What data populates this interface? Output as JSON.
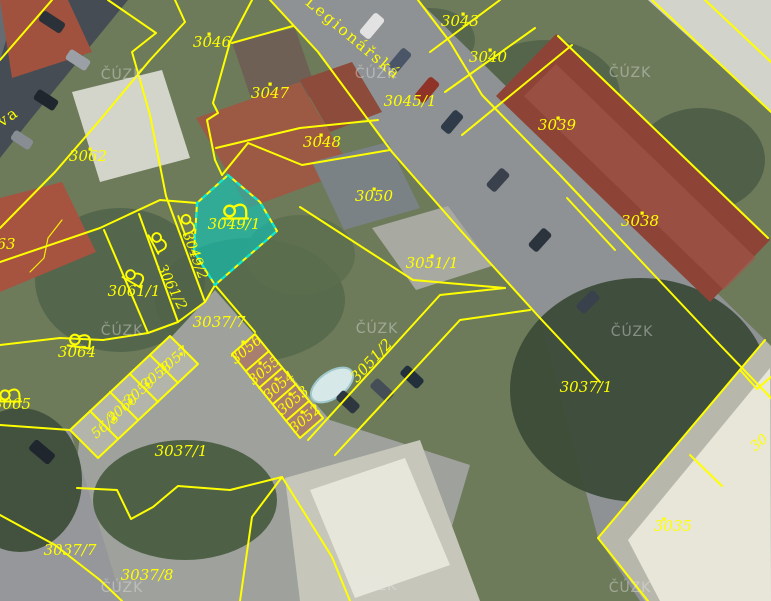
{
  "map": {
    "watermark_text": "ČÚZK",
    "watermarks": [
      {
        "x": 122,
        "y": 79
      },
      {
        "x": 376,
        "y": 78
      },
      {
        "x": 630,
        "y": 77
      },
      {
        "x": 122,
        "y": 335
      },
      {
        "x": 377,
        "y": 333
      },
      {
        "x": 632,
        "y": 336
      },
      {
        "x": 122,
        "y": 592
      },
      {
        "x": 376,
        "y": 590
      },
      {
        "x": 630,
        "y": 592
      }
    ],
    "street_labels": [
      {
        "text": "Legionářská",
        "x": 350,
        "y": 42,
        "rot": 40,
        "size": 15.5
      },
      {
        "text": "va",
        "x": 11,
        "y": 121,
        "rot": -35,
        "size": 15.5
      }
    ],
    "selected_parcel": "3049/1",
    "colors": {
      "boundary": "#ffff00",
      "label": "#ffff00",
      "highlight_fill": "#00d2c8",
      "highlight_stroke": "#00ecdc",
      "watermark": "#e8e8e8"
    },
    "parcel_labels": [
      {
        "text": "3046",
        "x": 212,
        "y": 47,
        "rot": 0,
        "size": 15,
        "dot": [
          209,
          34
        ]
      },
      {
        "text": "3047",
        "x": 270,
        "y": 98,
        "rot": 0,
        "size": 15,
        "dot": [
          270,
          84
        ]
      },
      {
        "text": "3048",
        "x": 322,
        "y": 147,
        "rot": 0,
        "size": 15,
        "dot": [
          321,
          135
        ]
      },
      {
        "text": "3045/1",
        "x": 410,
        "y": 106,
        "rot": 0,
        "size": 15,
        "dot": null
      },
      {
        "text": "3043",
        "x": 460,
        "y": 26,
        "rot": 0,
        "size": 15,
        "dot": [
          463,
          14
        ]
      },
      {
        "text": "3040",
        "x": 488,
        "y": 62,
        "rot": 0,
        "size": 15,
        "dot": [
          490,
          50
        ]
      },
      {
        "text": "3039",
        "x": 557,
        "y": 130,
        "rot": 0,
        "size": 15,
        "dot": [
          558,
          118
        ]
      },
      {
        "text": "3038",
        "x": 640,
        "y": 226,
        "rot": 0,
        "size": 15,
        "dot": [
          642,
          213
        ]
      },
      {
        "text": "3050",
        "x": 374,
        "y": 201,
        "rot": 0,
        "size": 15,
        "dot": [
          374,
          189
        ]
      },
      {
        "text": "3051/1",
        "x": 432,
        "y": 268,
        "rot": 0,
        "size": 15,
        "dot": [
          432,
          256
        ]
      },
      {
        "text": "3049/1",
        "x": 234,
        "y": 229,
        "rot": 0,
        "size": 15,
        "dot": null
      },
      {
        "text": "3049/2",
        "x": 191,
        "y": 257,
        "rot": 70,
        "size": 14,
        "dot": null
      },
      {
        "text": "3061/2",
        "x": 168,
        "y": 289,
        "rot": 63,
        "size": 14,
        "dot": null
      },
      {
        "text": "3061/1",
        "x": 134,
        "y": 296,
        "rot": 0,
        "size": 15,
        "dot": null
      },
      {
        "text": "3064",
        "x": 77,
        "y": 357,
        "rot": 0,
        "size": 15,
        "dot": null
      },
      {
        "text": "3065",
        "x": 12,
        "y": 409,
        "rot": 0,
        "size": 15,
        "dot": null
      },
      {
        "text": "63",
        "x": 6,
        "y": 249,
        "rot": 0,
        "size": 15,
        "dot": null
      },
      {
        "text": "3062",
        "x": 88,
        "y": 161,
        "rot": 0,
        "size": 15,
        "dot": [
          90,
          149
        ]
      },
      {
        "text": "3037/7",
        "x": 219,
        "y": 327,
        "rot": 0,
        "size": 15,
        "dot": null
      },
      {
        "text": "3037/1",
        "x": 586,
        "y": 392,
        "rot": 0,
        "size": 15,
        "dot": null
      },
      {
        "text": "3037/1",
        "x": 181,
        "y": 456,
        "rot": 0,
        "size": 15,
        "dot": null
      },
      {
        "text": "3037/7",
        "x": 70,
        "y": 555,
        "rot": 0,
        "size": 15,
        "dot": null
      },
      {
        "text": "3037/8",
        "x": 147,
        "y": 580,
        "rot": 0,
        "size": 15,
        "dot": null
      },
      {
        "text": "3035",
        "x": 673,
        "y": 531,
        "rot": 0,
        "size": 15,
        "dot": [
          664,
          519
        ]
      },
      {
        "text": "3051/2",
        "x": 375,
        "y": 364,
        "rot": -47,
        "size": 15,
        "dot": null
      },
      {
        "text": "3056",
        "x": 249,
        "y": 353,
        "rot": -40,
        "size": 14,
        "dot": [
          243,
          342
        ]
      },
      {
        "text": "3055",
        "x": 267,
        "y": 374,
        "rot": -40,
        "size": 14,
        "dot": [
          260,
          363
        ]
      },
      {
        "text": "3054",
        "x": 282,
        "y": 389,
        "rot": -40,
        "size": 14,
        "dot": [
          276,
          379
        ]
      },
      {
        "text": "3053",
        "x": 296,
        "y": 404,
        "rot": -40,
        "size": 14,
        "dot": [
          290,
          394
        ]
      },
      {
        "text": "3052",
        "x": 308,
        "y": 422,
        "rot": -40,
        "size": 14,
        "dot": [
          302,
          412
        ]
      },
      {
        "text": "3057",
        "x": 176,
        "y": 364,
        "rot": -40,
        "size": 14,
        "dot": [
          181,
          354
        ]
      },
      {
        "text": "3058",
        "x": 159,
        "y": 379,
        "rot": -40,
        "size": 14,
        "dot": [
          164,
          369
        ]
      },
      {
        "text": "3059",
        "x": 142,
        "y": 395,
        "rot": -40,
        "size": 14,
        "dot": [
          147,
          385
        ]
      },
      {
        "text": "3060",
        "x": 125,
        "y": 412,
        "rot": -40,
        "size": 14,
        "dot": [
          130,
          402
        ]
      },
      {
        "text": "56/3",
        "x": 108,
        "y": 429,
        "rot": -40,
        "size": 14,
        "dot": [
          113,
          419
        ]
      },
      {
        "text": "30",
        "x": 762,
        "y": 446,
        "rot": -40,
        "size": 14,
        "dot": null
      }
    ],
    "garden_symbols": [
      {
        "x": 233,
        "y": 211,
        "rot": 0,
        "s": 1.15
      },
      {
        "x": 187,
        "y": 222,
        "rot": 70,
        "s": 0.95
      },
      {
        "x": 158,
        "y": 240,
        "rot": 62,
        "s": 0.95
      },
      {
        "x": 133,
        "y": 276,
        "rot": 30,
        "s": 0.95
      },
      {
        "x": 78,
        "y": 340,
        "rot": 8,
        "s": 1.05
      },
      {
        "x": 8,
        "y": 395,
        "rot": 0,
        "s": 1.0
      }
    ]
  }
}
